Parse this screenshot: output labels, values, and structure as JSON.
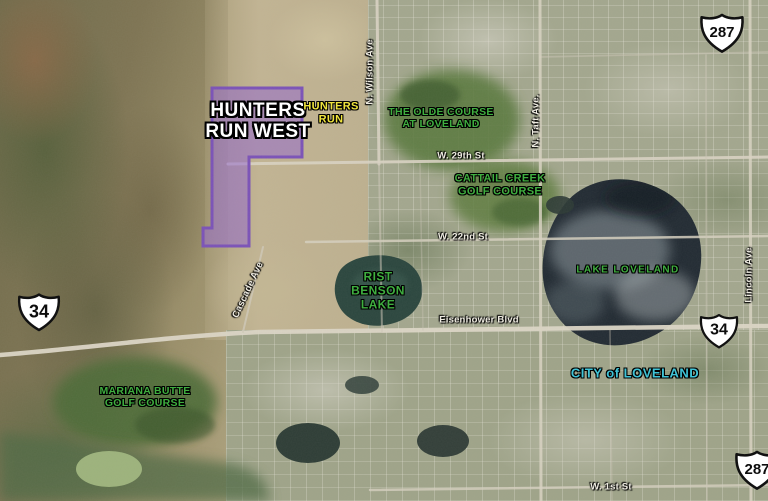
{
  "parcel": {
    "name_line1": "HUNTERS",
    "name_line2": "RUN WEST",
    "fill": "#9468ce",
    "border": "#7b52b8"
  },
  "place_labels": {
    "hunters_run": {
      "line1": "HUNTERS",
      "line2": "RUN",
      "color": "#f0e43c"
    },
    "olde_course": {
      "line1": "THE OLDE COURSE",
      "line2": "AT LOVELAND",
      "color": "#3fae3f"
    },
    "cattail_creek": {
      "line1": "CATTAIL CREEK",
      "line2": "GOLF COURSE",
      "color": "#3fae3f"
    },
    "lake_loveland": {
      "text": "LAKE LOVELAND",
      "color": "#3fae3f"
    },
    "rist_benson_lake": {
      "line1": "RIST",
      "line2": "BENSON",
      "line3": "LAKE",
      "color": "#3fae3f"
    },
    "mariana_butte": {
      "line1": "MARIANA BUTTE",
      "line2": "GOLF COURSE",
      "color": "#3fae3f"
    },
    "city_of_loveland": {
      "text": "CITY of LOVELAND",
      "color": "#3fc3d6"
    }
  },
  "street_labels": {
    "w_29th_st": "W. 29th St",
    "w_22nd_st": "W. 22nd St",
    "eisenhower_blvd": "Eisenhower Blvd",
    "w_1st_st": "W. 1st St",
    "n_wilson_ave": "N. Wilson Ave",
    "n_taft_ave": "N. Taft Ave.",
    "lincoln_ave": "Lincoln Ave",
    "cascade_ave": "Cascade Ave"
  },
  "highway_shields": [
    {
      "route": "287",
      "position": "top-right"
    },
    {
      "route": "34",
      "position": "left"
    },
    {
      "route": "34",
      "position": "right"
    },
    {
      "route": "287",
      "position": "bottom-right"
    }
  ],
  "colors": {
    "street_label": "#efece2",
    "golf_label": "#3fae3f",
    "city_label": "#3fc3d6",
    "hunters_run_label": "#f0e43c",
    "parcel_fill": "#9468ce"
  }
}
